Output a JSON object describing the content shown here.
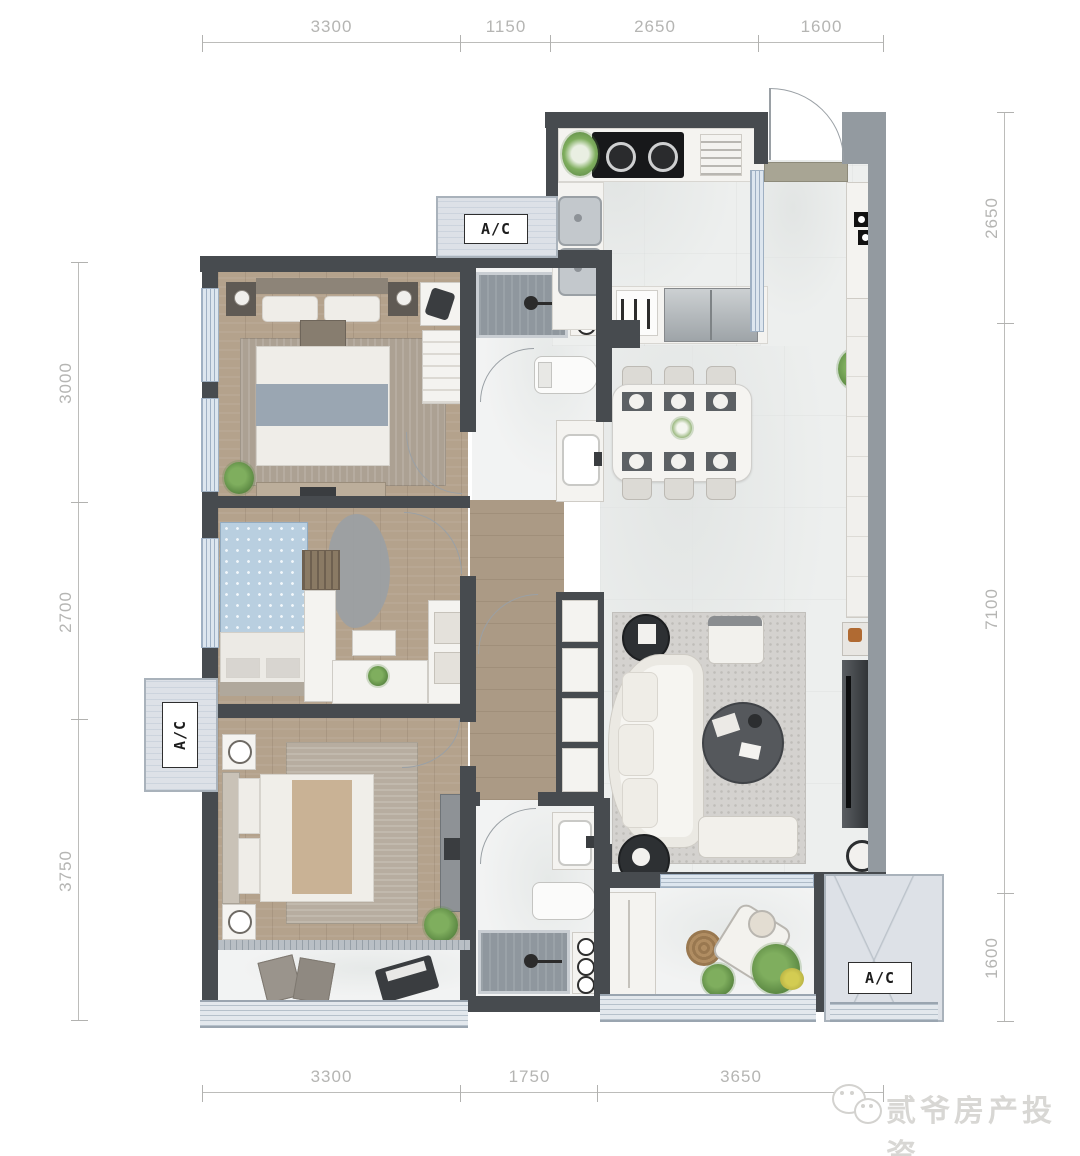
{
  "dims": {
    "top": [
      "3300",
      "1150",
      "2650",
      "1600"
    ],
    "bottom": [
      "3300",
      "1750",
      "3650"
    ],
    "left": [
      "3000",
      "2700",
      "3750"
    ],
    "right": [
      "2650",
      "7100",
      "1600"
    ]
  },
  "labels": {
    "ac": "A/C"
  },
  "watermark": {
    "text": "贰爷房产投资"
  },
  "colors": {
    "wall_dark": "#474b4f",
    "wall_light": "#939aa0",
    "window_blue": "#dde6ef",
    "wood_floor": "#b4a28c",
    "marble_floor": "#edefee",
    "dim_text": "#b5b5b3",
    "plant_green": "#5d8a44"
  }
}
